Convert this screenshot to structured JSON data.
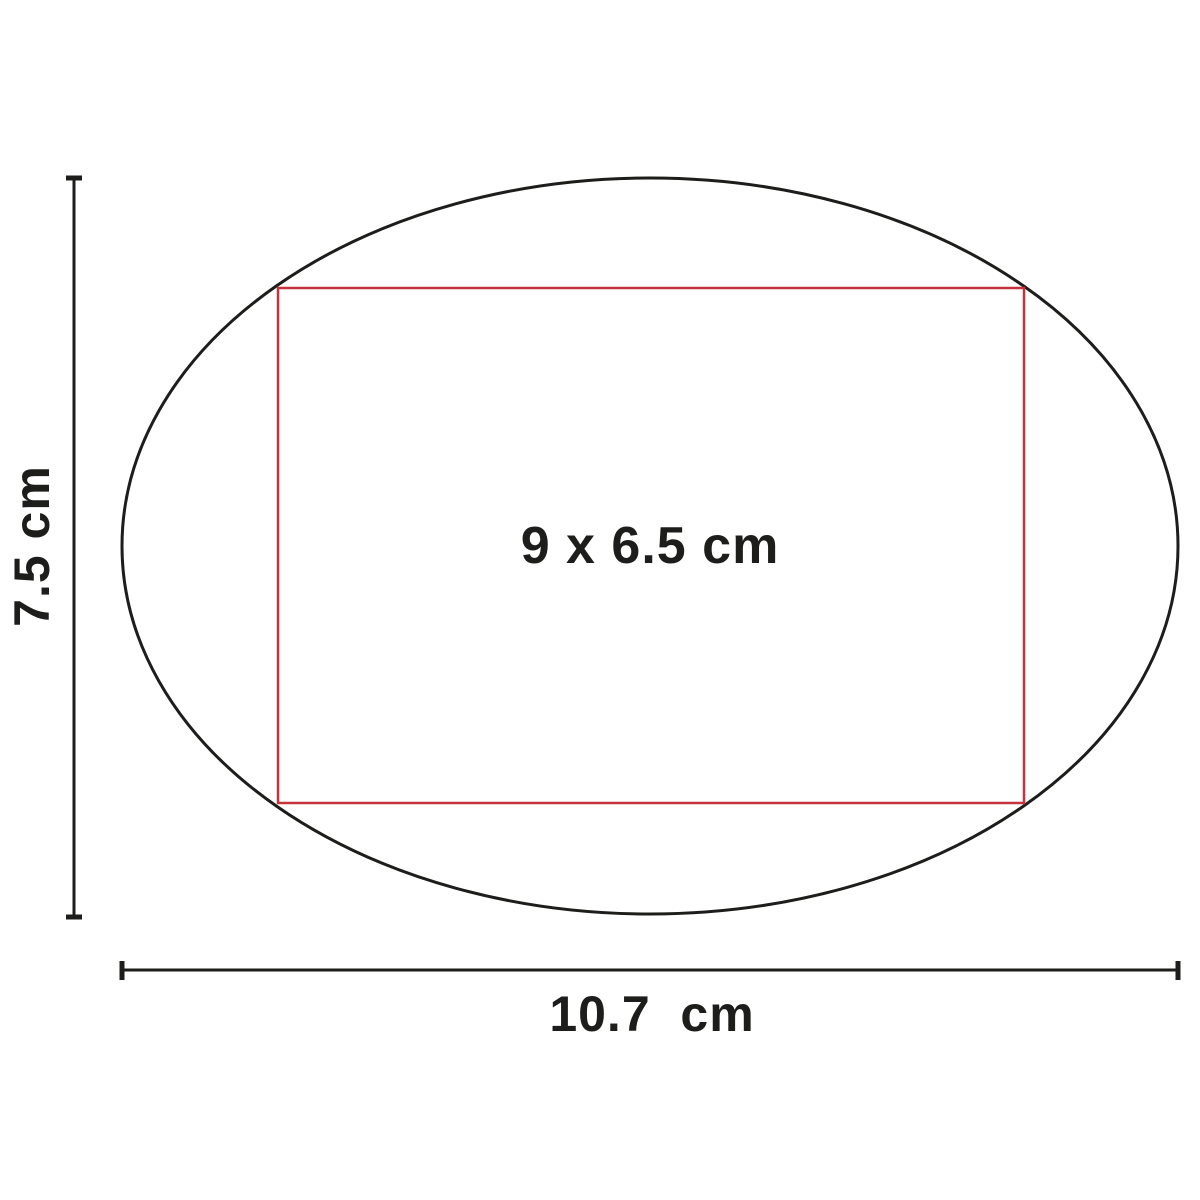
{
  "diagram": {
    "kind": "product-print-area-dimension-diagram",
    "print_area_label": "9 x 6.5 cm",
    "height_label": "7.5 cm",
    "width_label": "10.7  cm",
    "colors": {
      "outline": "#1d1d1b",
      "print_area": "#c5333d",
      "text": "#1d1d1b",
      "background": "#ffffff"
    }
  }
}
